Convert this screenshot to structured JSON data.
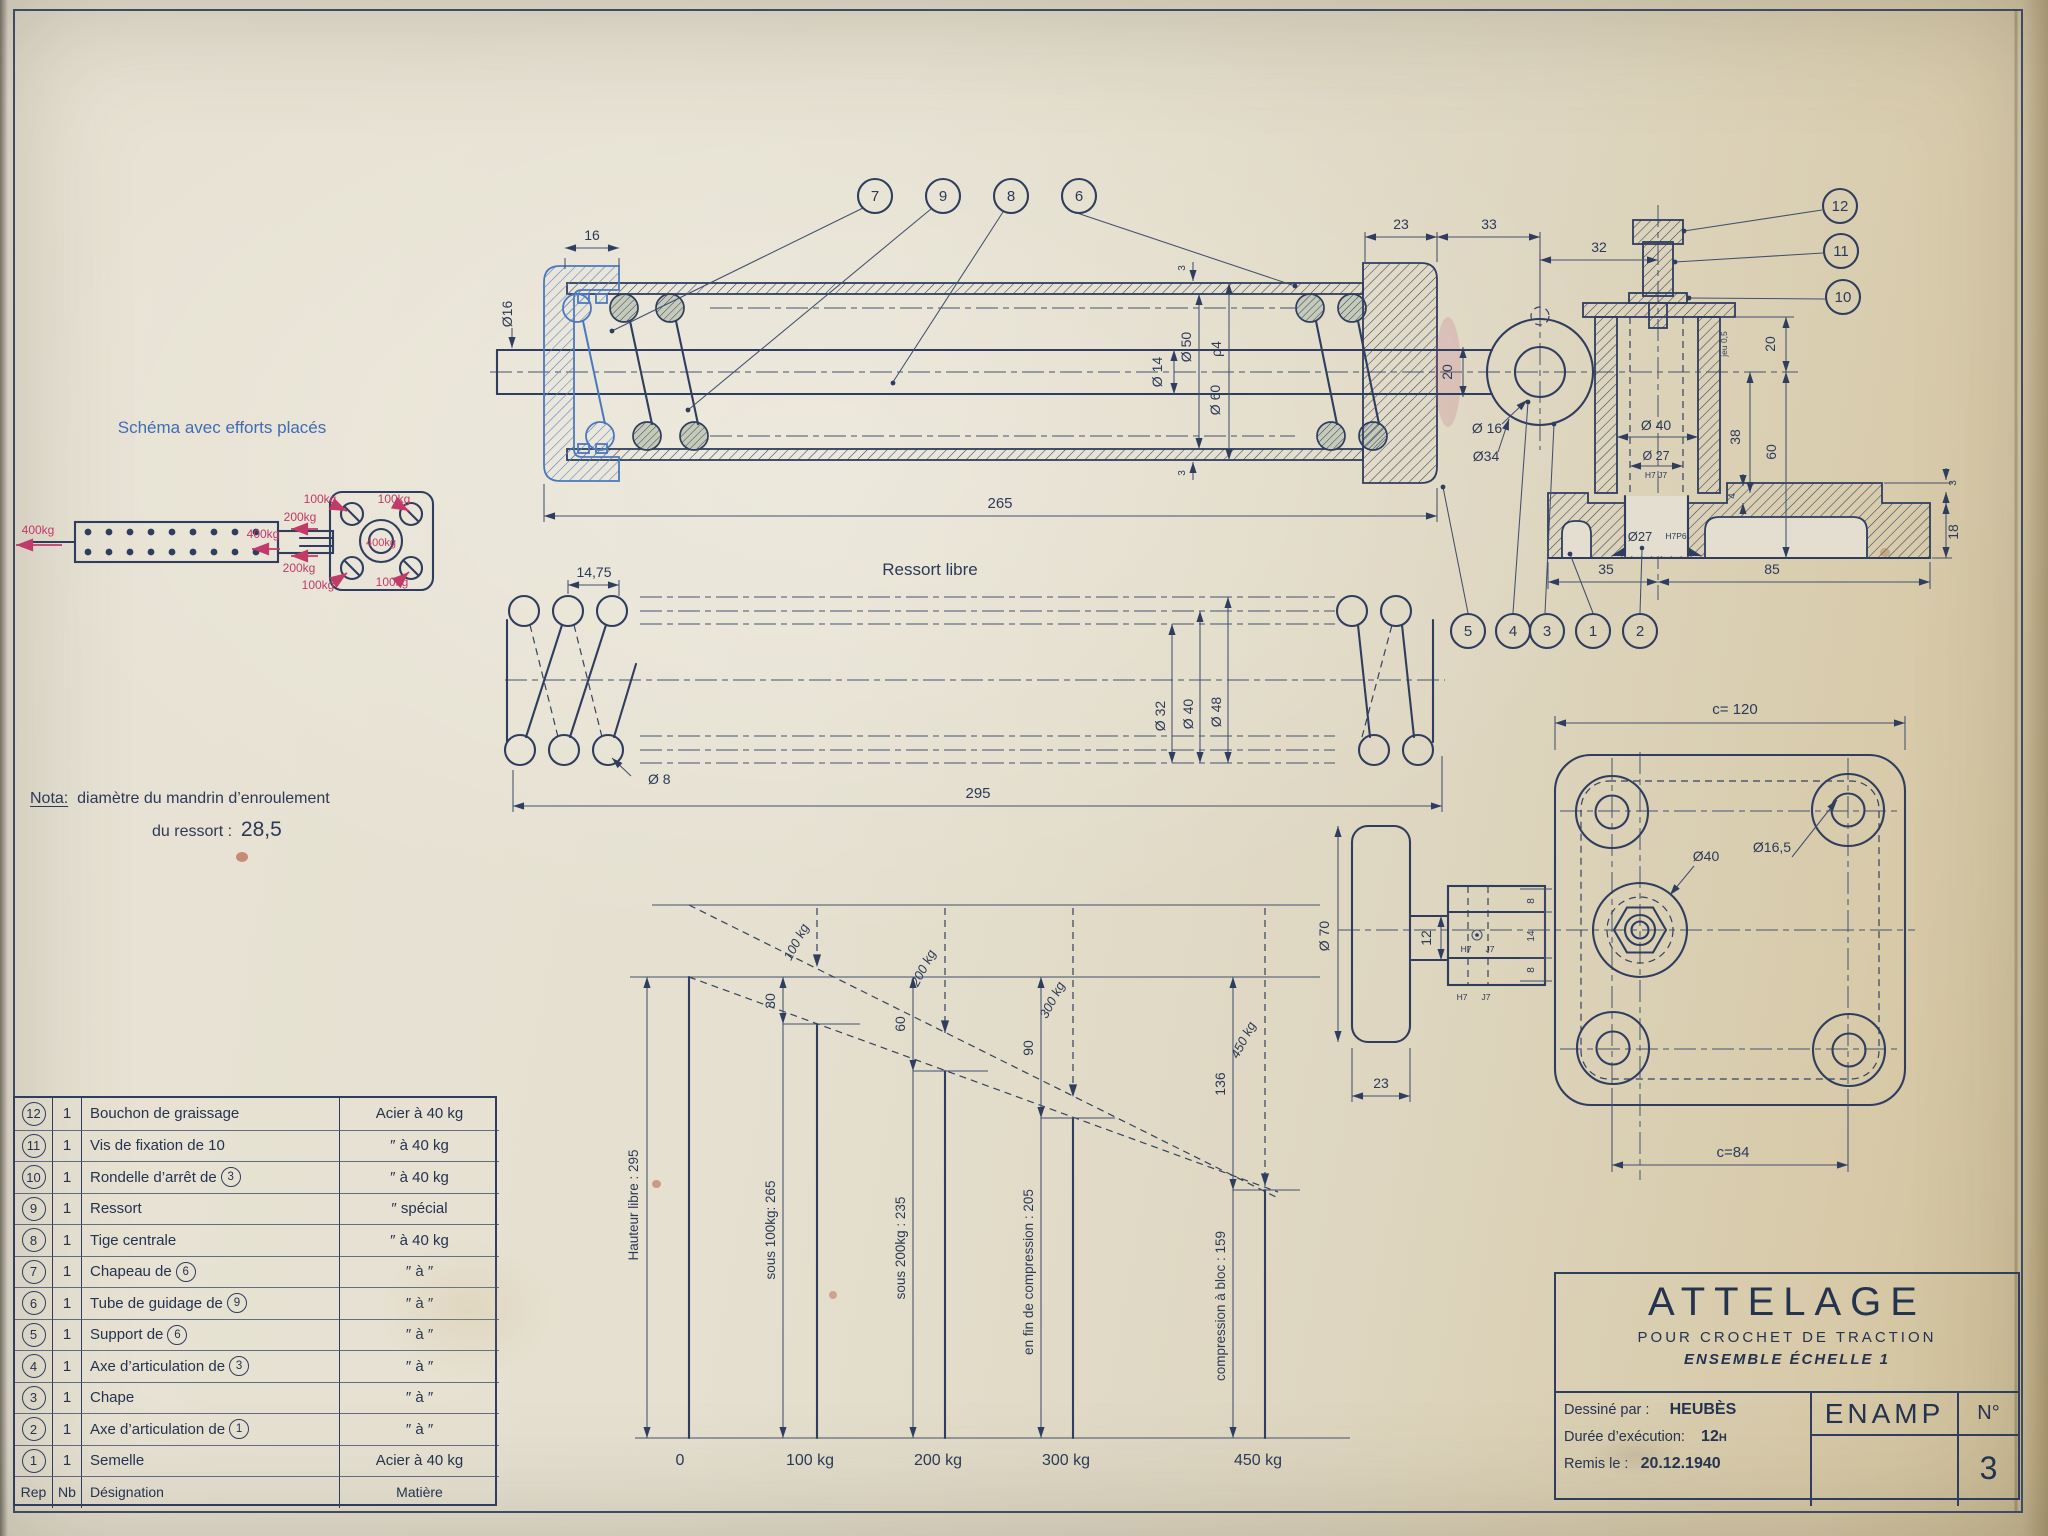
{
  "schema": {
    "title": "Schéma avec efforts placés",
    "force_left": "400kg",
    "force_rod": "400kg",
    "force_top": "200kg",
    "force_bottom": "200kg",
    "force_center": "400kg",
    "force_corner_tl": "100kg",
    "force_corner_tr": "100kg",
    "force_corner_bl": "100kg",
    "force_corner_br": "100kg"
  },
  "nota": {
    "label": "Nota:",
    "line1": "diamètre du mandrin d’enroulement",
    "line2": "du ressort :",
    "value": "28,5"
  },
  "main_view": {
    "callouts_top": [
      "7",
      "9",
      "8",
      "6"
    ],
    "callouts_right": [
      "12",
      "11",
      "10"
    ],
    "callouts_bottom": [
      "5",
      "4",
      "3",
      "1",
      "2"
    ],
    "dims": {
      "d16": "16",
      "phi16_rod": "Ø16",
      "d265": "265",
      "d23": "23",
      "d33": "33",
      "d32": "32",
      "d3_top": "3",
      "d3_bot": "3",
      "phi14": "Ø 14",
      "phi50": "Ø 50",
      "rho4": "ρ4",
      "phi60": "Ø 60",
      "d20_neck": "20",
      "phi16_axle": "Ø 16",
      "phi34": "Ø34",
      "phi40": "Ø 40",
      "phi27": "Ø 27",
      "tol27": "H7 J7",
      "jeu": "jeu 0,5",
      "d20r": "20",
      "d38": "38",
      "d60": "60",
      "d4": "4",
      "d3_lip": "3",
      "d18": "18",
      "d35": "35",
      "d85": "85",
      "phi27b": "Ø27",
      "tol27b": "H7P6"
    }
  },
  "spring_view": {
    "title": "Ressort libre",
    "p1475": "14,75",
    "phi8": "Ø 8",
    "d295": "295",
    "phi32": "Ø 32",
    "phi40": "Ø 40",
    "phi48": "Ø 48"
  },
  "plan_view": {
    "c120": "c= 120",
    "c84": "c=84",
    "phi40": "Ø40",
    "phi165": "Ø16,5",
    "phi70": "Ø 70",
    "d23": "23",
    "d12": "12",
    "d8a": "8",
    "d14": "14",
    "d8b": "8",
    "tol1": "H7",
    "tol2": "J7",
    "tol3": "H7",
    "tol4": "J7"
  },
  "chart_data": {
    "type": "bar",
    "title": "",
    "categories": [
      "0",
      "100 kg",
      "200 kg",
      "300 kg",
      "450 kg"
    ],
    "values": [
      295,
      265,
      235,
      205,
      159
    ],
    "bar_labels": [
      "Hauteur libre : 295",
      "sous 100kg: 265",
      "sous 200kg : 235",
      "en fin de compression : 205",
      "compression à bloc : 159"
    ],
    "deflection_labels": [
      "30",
      "60",
      "90",
      "136"
    ],
    "load_labels": [
      "100 kg",
      "200 kg",
      "300 kg",
      "450 kg"
    ],
    "xlabel": "",
    "ylabel": "",
    "grid": false,
    "legend": false
  },
  "parts_table": {
    "header": {
      "rep": "Rep",
      "nb": "Nb",
      "designation": "Désignation",
      "matiere": "Matière"
    },
    "rows": [
      {
        "rep": "12",
        "nb": "1",
        "designation": "Bouchon de graissage",
        "matiere": "Acier à 40 kg"
      },
      {
        "rep": "11",
        "nb": "1",
        "designation": "Vis de fixation de 10",
        "matiere": "″  à 40 kg"
      },
      {
        "rep": "10",
        "nb": "1",
        "designation": "Rondelle d’arrêt de",
        "ref": "3",
        "matiere": "″  à 40 kg"
      },
      {
        "rep": "9",
        "nb": "1",
        "designation": "Ressort",
        "matiere": "″  spécial"
      },
      {
        "rep": "8",
        "nb": "1",
        "designation": "Tige centrale",
        "matiere": "″  à 40 kg"
      },
      {
        "rep": "7",
        "nb": "1",
        "designation": "Chapeau de",
        "ref": "6",
        "matiere": "″  à  ″"
      },
      {
        "rep": "6",
        "nb": "1",
        "designation": "Tube de guidage de",
        "ref": "9",
        "matiere": "″  à  ″"
      },
      {
        "rep": "5",
        "nb": "1",
        "designation": "Support de",
        "ref": "6",
        "matiere": "″  à  ″"
      },
      {
        "rep": "4",
        "nb": "1",
        "designation": "Axe d’articulation de",
        "ref": "3",
        "matiere": "″  à  ″"
      },
      {
        "rep": "3",
        "nb": "1",
        "designation": "Chape",
        "matiere": "″  à  ″"
      },
      {
        "rep": "2",
        "nb": "1",
        "designation": "Axe d’articulation de",
        "ref": "1",
        "matiere": "″  à  ″"
      },
      {
        "rep": "1",
        "nb": "1",
        "designation": "Semelle",
        "matiere": "Acier à 40 kg"
      }
    ]
  },
  "title_block": {
    "title": "ATTELAGE",
    "line2": "POUR CROCHET DE TRACTION",
    "line3": "ENSEMBLE ÉCHELLE 1",
    "drawn_label": "Dessiné par :",
    "drawn_value": "HEUBÈS",
    "duration_label": "Durée d’exécution:",
    "duration_value": "12",
    "duration_sup": "H",
    "date_label": "Remis le :",
    "date_value": "20.12.1940",
    "org": "ENAMP",
    "num_label": "N°",
    "num_value": "3"
  }
}
